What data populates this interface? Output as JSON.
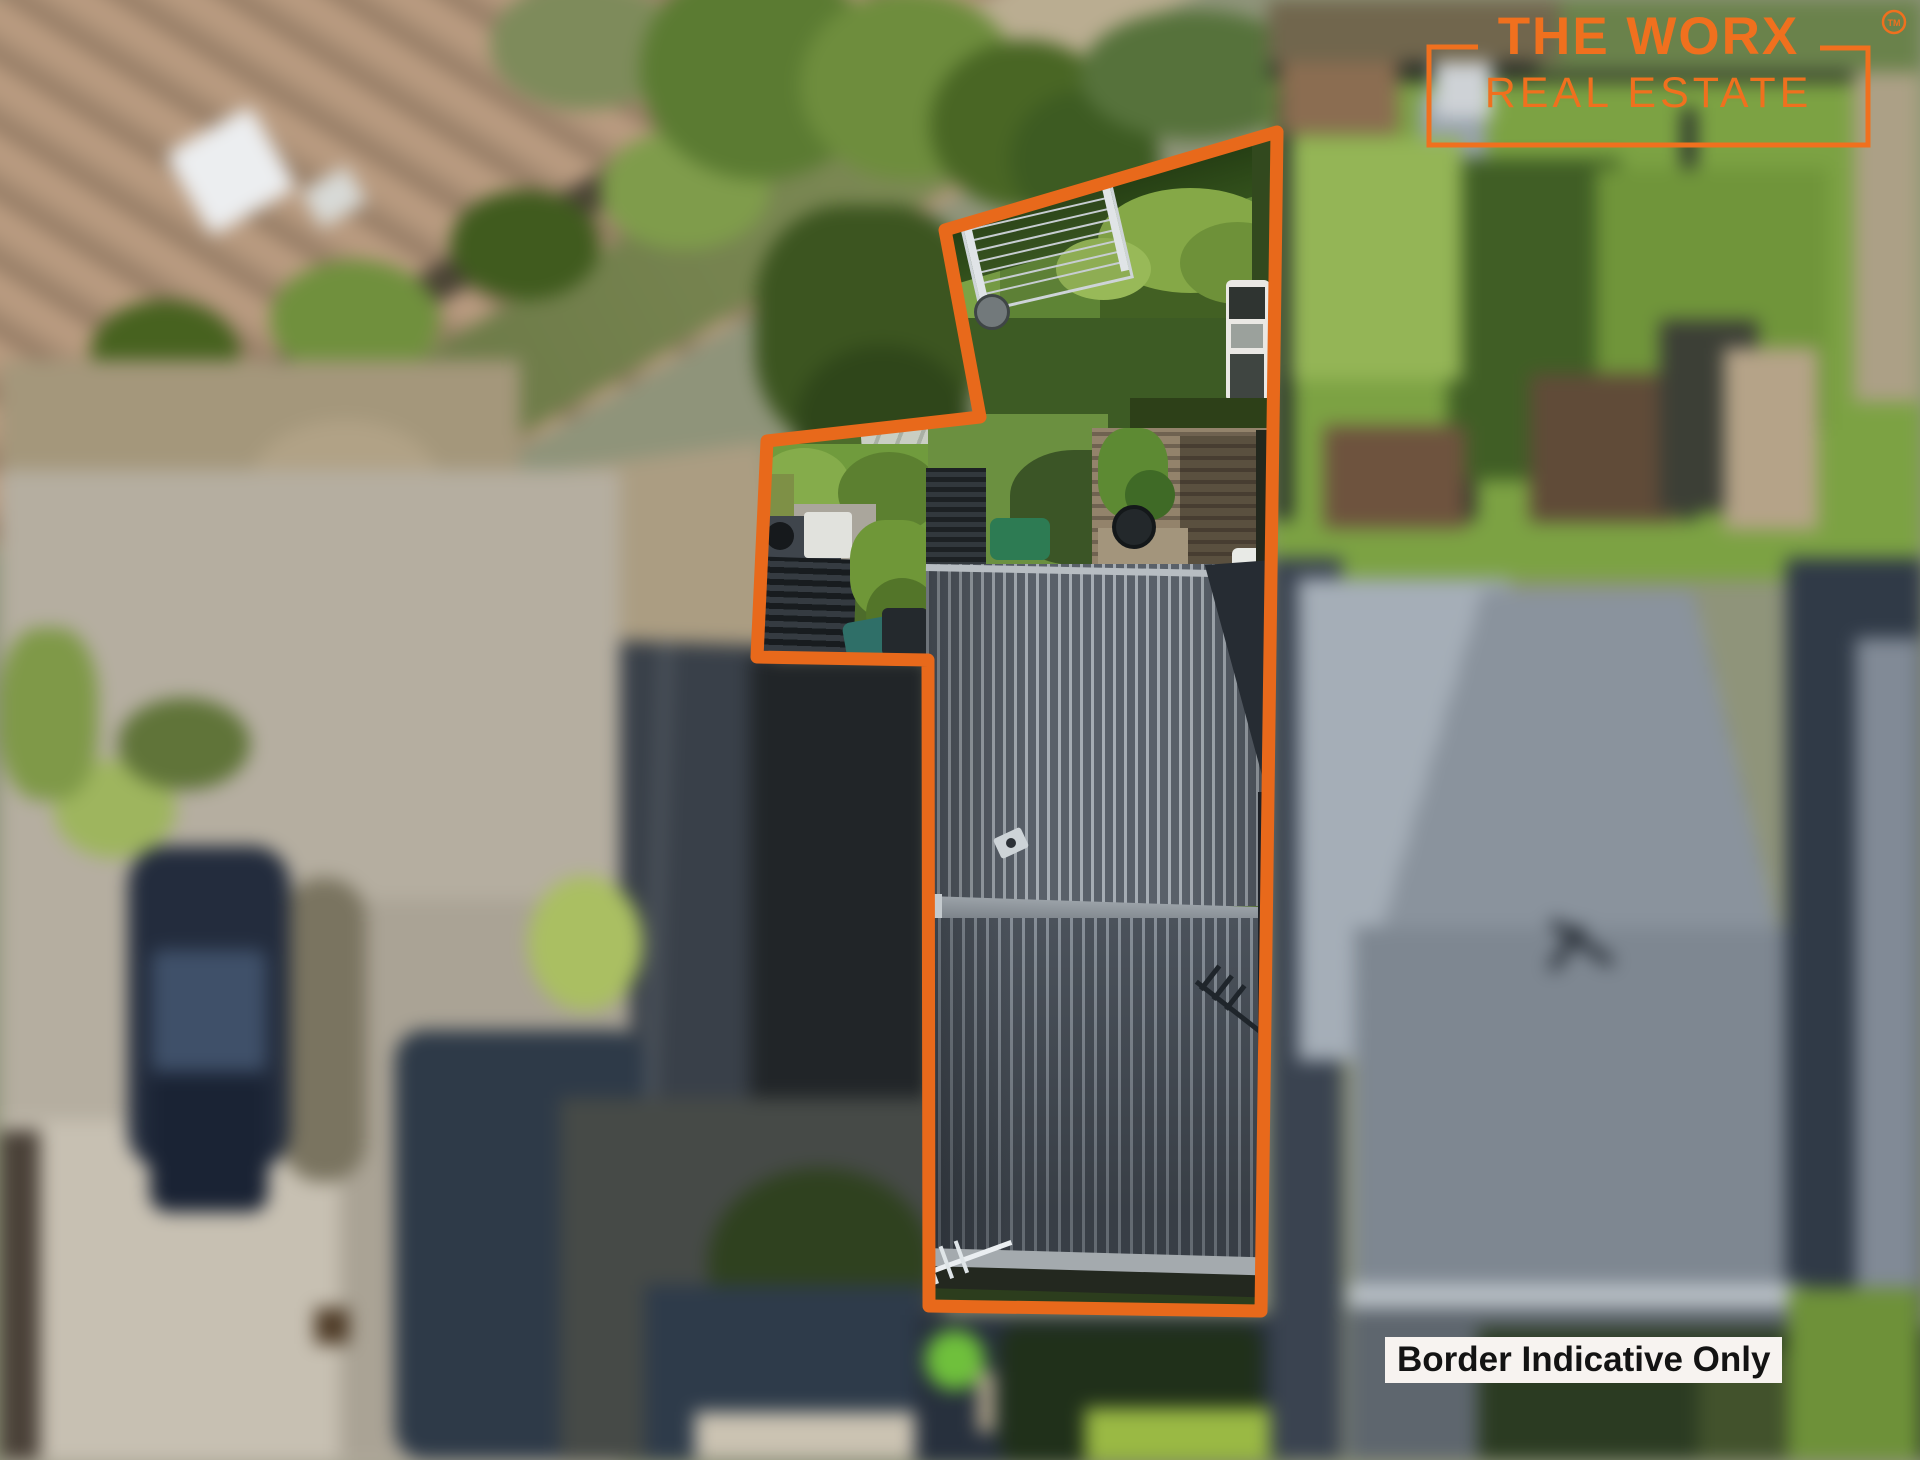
{
  "branding": {
    "logo_line1": "THE WORX",
    "logo_line2": "REAL ESTATE",
    "trademark": "TM"
  },
  "overlay": {
    "disclaimer_text": "Border Indicative Only"
  },
  "colors": {
    "brand_orange": "#F0701E",
    "border_orange": "#E8691B",
    "label_background": "#F7F3F0",
    "label_text": "#131313"
  },
  "scene": {
    "type": "aerial-drone-photo",
    "highlight": "property-outlined-with-orange-border"
  }
}
